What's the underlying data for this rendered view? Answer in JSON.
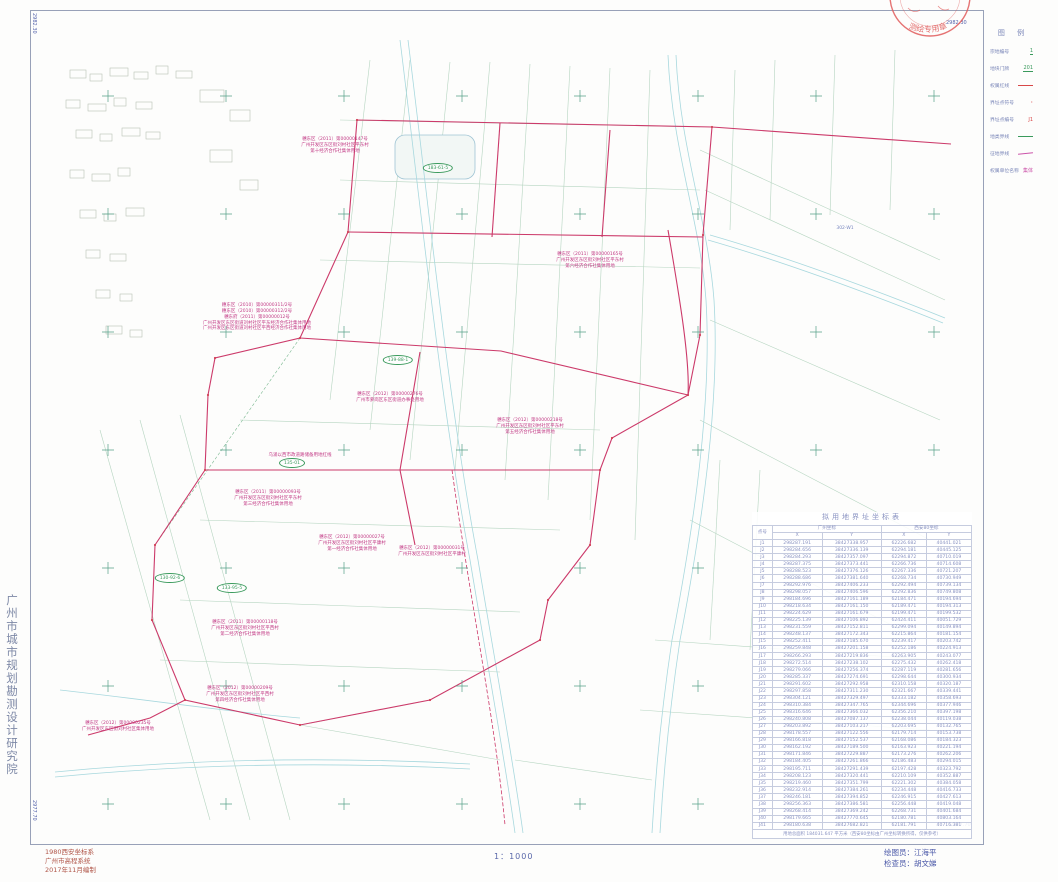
{
  "sheet": {
    "corner_coords": {
      "top_left": "2982.30",
      "top_right": "2982.30",
      "bottom_left": "2977.70",
      "bottom_right": "2977.70"
    },
    "institute_vertical": "广州市城市规划勘测设计研究院",
    "stamp_text": "测绘专用章",
    "bottom_left_lines": [
      "1980西安坐标系",
      "广州市高程系统",
      "2017年11月编制"
    ],
    "scale_label": "1：1000",
    "drafter": "绘图员：江海平",
    "checker": "检查员：胡文娣"
  },
  "legend": {
    "title": "图 例",
    "items": [
      {
        "label": "宗地编号",
        "sample": "1",
        "type": "green-text"
      },
      {
        "label": "地块门牌",
        "sample": "201",
        "type": "green-text"
      },
      {
        "label": "权属红线",
        "sample": "",
        "type": "red-line"
      },
      {
        "label": "界址点符号",
        "sample": "·",
        "type": "red-dot"
      },
      {
        "label": "界址点编号",
        "sample": "J1",
        "type": "red-text"
      },
      {
        "label": "地类界线",
        "sample": "",
        "type": "green-line"
      },
      {
        "label": "征地界线",
        "sample": "",
        "type": "magenta-line"
      },
      {
        "label": "权属单位名称",
        "sample": "集体",
        "type": "magenta-text"
      }
    ]
  },
  "table": {
    "title": "拟用地界址坐标表",
    "col_point": "点号",
    "group1": "广州坐标",
    "group2": "西安80坐标",
    "sub": [
      "X",
      "Y",
      "X",
      "Y"
    ],
    "rows": [
      [
        "J1",
        "298287.191",
        "38427338.957",
        "62226.682",
        "40441.021"
      ],
      [
        "J2",
        "298284.656",
        "38427336.139",
        "62294.181",
        "40445.125"
      ],
      [
        "J3",
        "298284.293",
        "38427357.097",
        "62294.872",
        "40710.019"
      ],
      [
        "J4",
        "298287.375",
        "38427373.441",
        "62266.736",
        "40714.608"
      ],
      [
        "J5",
        "298288.523",
        "38427376.126",
        "62267.336",
        "40721.207"
      ],
      [
        "J6",
        "298288.686",
        "38427381.640",
        "62268.734",
        "40730.949"
      ],
      [
        "J7",
        "298292.976",
        "38427406.233",
        "62292.494",
        "40739.134"
      ],
      [
        "J8",
        "298298.057",
        "38427406.596",
        "62292.836",
        "40749.808"
      ],
      [
        "J9",
        "298184.696",
        "38427161.189",
        "62184.471",
        "40194.694"
      ],
      [
        "J10",
        "298218.634",
        "38427161.150",
        "62189.471",
        "40194.313"
      ],
      [
        "J11",
        "298224.629",
        "38427161.679",
        "62199.471",
        "40199.532"
      ],
      [
        "J12",
        "298225.139",
        "38427106.892",
        "62424.411",
        "40051.729"
      ],
      [
        "J13",
        "298231.559",
        "38427152.811",
        "62299.094",
        "40149.894"
      ],
      [
        "J14",
        "298248.137",
        "38427172.343",
        "62215.864",
        "40181.154"
      ],
      [
        "J15",
        "298252.411",
        "38427185.670",
        "62239.417",
        "40203.742"
      ],
      [
        "J16",
        "298259.848",
        "38427201.158",
        "62252.186",
        "40224.913"
      ],
      [
        "J17",
        "298266.293",
        "38427219.836",
        "62263.905",
        "40243.077"
      ],
      [
        "J18",
        "298272.514",
        "38427238.102",
        "62275.432",
        "40262.418"
      ],
      [
        "J19",
        "298279.066",
        "38427256.374",
        "62287.119",
        "40281.656"
      ],
      [
        "J20",
        "298285.337",
        "38427274.691",
        "62298.644",
        "40300.934"
      ],
      [
        "J21",
        "298291.602",
        "38427292.958",
        "62310.158",
        "40320.187"
      ],
      [
        "J22",
        "298297.858",
        "38427311.230",
        "62321.667",
        "40339.441"
      ],
      [
        "J23",
        "298304.121",
        "38427329.497",
        "62333.182",
        "40358.693"
      ],
      [
        "J24",
        "298310.384",
        "38427347.765",
        "62344.696",
        "40377.946"
      ],
      [
        "J25",
        "298316.646",
        "38427366.032",
        "62356.210",
        "40397.198"
      ],
      [
        "J26",
        "298240.808",
        "38427087.137",
        "62238.044",
        "40119.038"
      ],
      [
        "J27",
        "298203.892",
        "38427103.217",
        "62203.695",
        "40132.765"
      ],
      [
        "J28",
        "298178.557",
        "38427122.556",
        "62179.714",
        "40153.738"
      ],
      [
        "J29",
        "298166.818",
        "38427152.537",
        "62168.086",
        "40184.323"
      ],
      [
        "J30",
        "298162.192",
        "38427189.500",
        "62163.923",
        "40221.194"
      ],
      [
        "J31",
        "298171.846",
        "38427229.887",
        "62173.276",
        "40262.206"
      ],
      [
        "J32",
        "298184.405",
        "38427261.866",
        "62186.483",
        "40294.015"
      ],
      [
        "J33",
        "298195.711",
        "38427291.439",
        "62197.428",
        "40323.792"
      ],
      [
        "J34",
        "298208.123",
        "38427320.441",
        "62210.109",
        "40352.887"
      ],
      [
        "J35",
        "298219.460",
        "38427351.799",
        "62221.302",
        "40384.058"
      ],
      [
        "J36",
        "298232.914",
        "38427384.261",
        "62234.448",
        "40416.733"
      ],
      [
        "J37",
        "298246.181",
        "38427394.852",
        "62246.915",
        "40427.613"
      ],
      [
        "J38",
        "298256.363",
        "38427386.581",
        "62256.448",
        "40419.048"
      ],
      [
        "J39",
        "298268.414",
        "38427369.242",
        "62268.731",
        "40401.684"
      ],
      [
        "J40",
        "298179.665",
        "38427770.645",
        "62180.781",
        "40803.164"
      ],
      [
        "J41",
        "298180.638",
        "38427682.821",
        "62181.791",
        "40716.381"
      ]
    ],
    "footer": "用地总面积 184031.647 平方米（西安80坐标由广州坐标转换所得，仅供参考）"
  },
  "map": {
    "annotations": [
      {
        "x": 335,
        "y": 137,
        "lines": [
          "穗东区（2011）第00000147号",
          "广州开发区东区街刘村社区平东村",
          "第十经济合作社集体用地"
        ]
      },
      {
        "x": 590,
        "y": 252,
        "lines": [
          "穗东区（2011）第00000165号",
          "广州开发区东区街刘村社区平东村",
          "第六经济合作社集体用地"
        ]
      },
      {
        "x": 257,
        "y": 303,
        "lines": [
          "穗东区（2010）第00000311/2号",
          "穗东区（2010）第00000312/2号",
          "穗东府（2011）第00000012号",
          "广州开发区东区街道刘村社区平东经济合作社集体用地",
          "广州开发区东区街道刘村社区平西经济合作社集体用地"
        ]
      },
      {
        "x": 390,
        "y": 392,
        "lines": [
          "穗东区（2012）第00000276号",
          "广州市萝岗区东区街道办事处用地"
        ]
      },
      {
        "x": 530,
        "y": 418,
        "lines": [
          "穗东区（2012）第00000218号",
          "广州开发区东区街刘村社区平东村",
          "第五经济合作社集体用地"
        ]
      },
      {
        "x": 300,
        "y": 453,
        "lines": [
          "乌涌以西市政道路储备用地红线"
        ]
      },
      {
        "x": 268,
        "y": 490,
        "lines": [
          "穗东区（2011）第00000093号",
          "广州开发区东区街刘村社区平东村",
          "第三经济合作社集体用地"
        ]
      },
      {
        "x": 352,
        "y": 535,
        "lines": [
          "穗东区（2012）第00000027号",
          "广州开发区东区街刘村社区平康村",
          "第一经济合作社集体用地"
        ]
      },
      {
        "x": 432,
        "y": 546,
        "lines": [
          "穗东区（2012）第00000031号",
          "广州开发区东区街刘村社区平康村"
        ]
      },
      {
        "x": 245,
        "y": 620,
        "lines": [
          "穗东区（2011）第00000118号",
          "广州开发区东区街刘村社区平西村",
          "第二经济合作社集体用地"
        ]
      },
      {
        "x": 240,
        "y": 686,
        "lines": [
          "穗东区（2012）第00000209号",
          "广州开发区东区街刘村社区平西村",
          "第四经济合作社集体用地"
        ]
      },
      {
        "x": 118,
        "y": 721,
        "lines": [
          "穗东区（2012）第00000235号",
          "广州开发区东区街刘村社区集体用地"
        ]
      }
    ],
    "oval_labels": [
      {
        "x": 292,
        "y": 463,
        "text": "135-01"
      },
      {
        "x": 232,
        "y": 588,
        "text": "133-95-5"
      },
      {
        "x": 438,
        "y": 168,
        "text": "183-61-5"
      },
      {
        "x": 398,
        "y": 360,
        "text": "139-88-1"
      },
      {
        "x": 170,
        "y": 578,
        "text": "130-92-6"
      }
    ],
    "blue_labels": [
      {
        "x": 845,
        "y": 226,
        "text": "302-W1"
      }
    ]
  }
}
